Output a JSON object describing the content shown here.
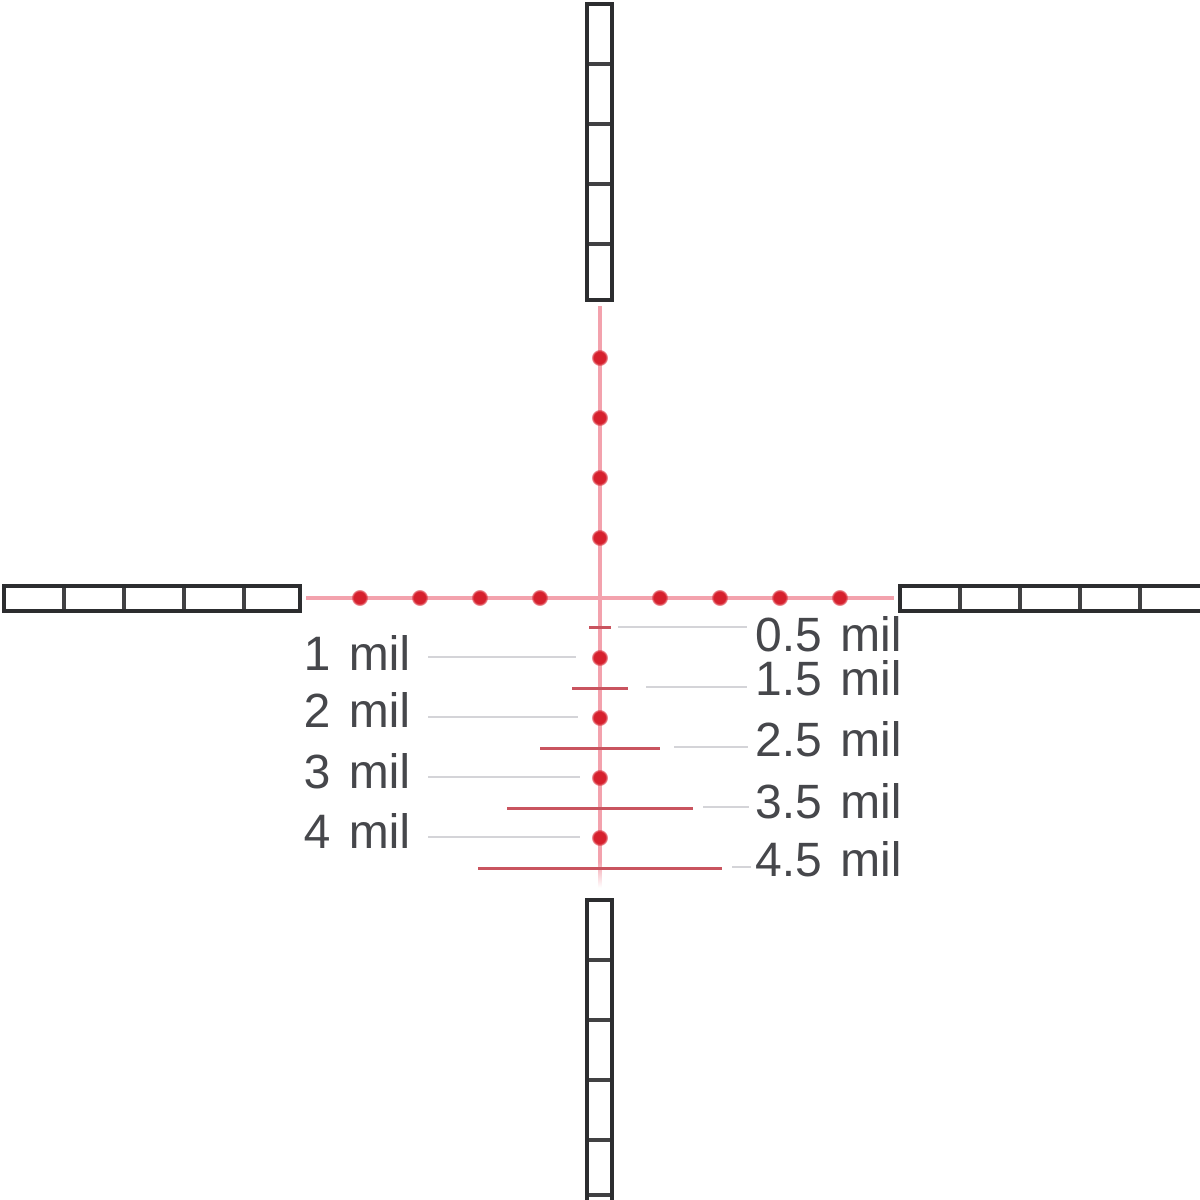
{
  "diagram": {
    "title": "riflescope-mil-reticle-diagram",
    "unit": "mil",
    "mil_spacing_px": 60,
    "center_px": {
      "x": 600,
      "y": 598
    },
    "dot_positions_mil": [
      1,
      2,
      3,
      4
    ],
    "hash_positions_mil": [
      0.5,
      1.5,
      2.5,
      3.5,
      4.5
    ],
    "post_segments_per_arm": 5,
    "left_labels": [
      "1 mil",
      "2 mil",
      "3 mil",
      "4 mil"
    ],
    "right_labels": [
      "0.5 mil",
      "1.5 mil",
      "2.5 mil",
      "3.5 mil",
      "4.5 mil"
    ],
    "colors": {
      "dot_red": "#d6212e",
      "hash_red": "#c9545f",
      "hairline_pink": "#f3a2ad",
      "callout_gray": "#d4d4d8",
      "label_gray": "#46474b",
      "post_black": "#2c2d2f",
      "background": "#ffffff"
    }
  }
}
